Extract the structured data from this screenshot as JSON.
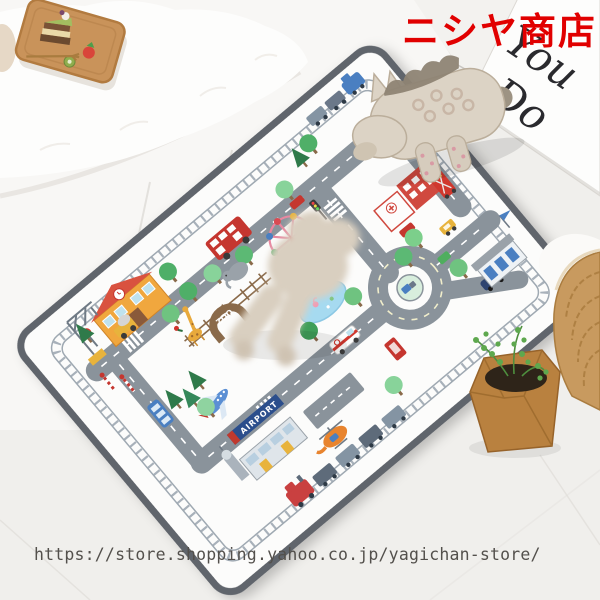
{
  "overlay": {
    "shop_name": "ニシヤ商店",
    "url": "https://store.shopping.yahoo.co.jp/yagichan-store/"
  },
  "sign_board": {
    "line1": "You",
    "line2": "Do"
  },
  "playmat": {
    "zoo_label": "ZOO",
    "airport_label": "AIRPORT"
  },
  "colors": {
    "shop_name_red": "#e10000",
    "url_text": "#53504c",
    "mat_edge": "#60656c",
    "road_gray": "#8a939b",
    "railway_gray": "#9fa9b2",
    "pond_blue": "#a6daf0",
    "tree_green": "#4faf68",
    "accent_red": "#c5362f",
    "plush_beige": "#dcd3c5",
    "tray_wood": "#c9935a",
    "basket_tan": "#c89a5f"
  }
}
